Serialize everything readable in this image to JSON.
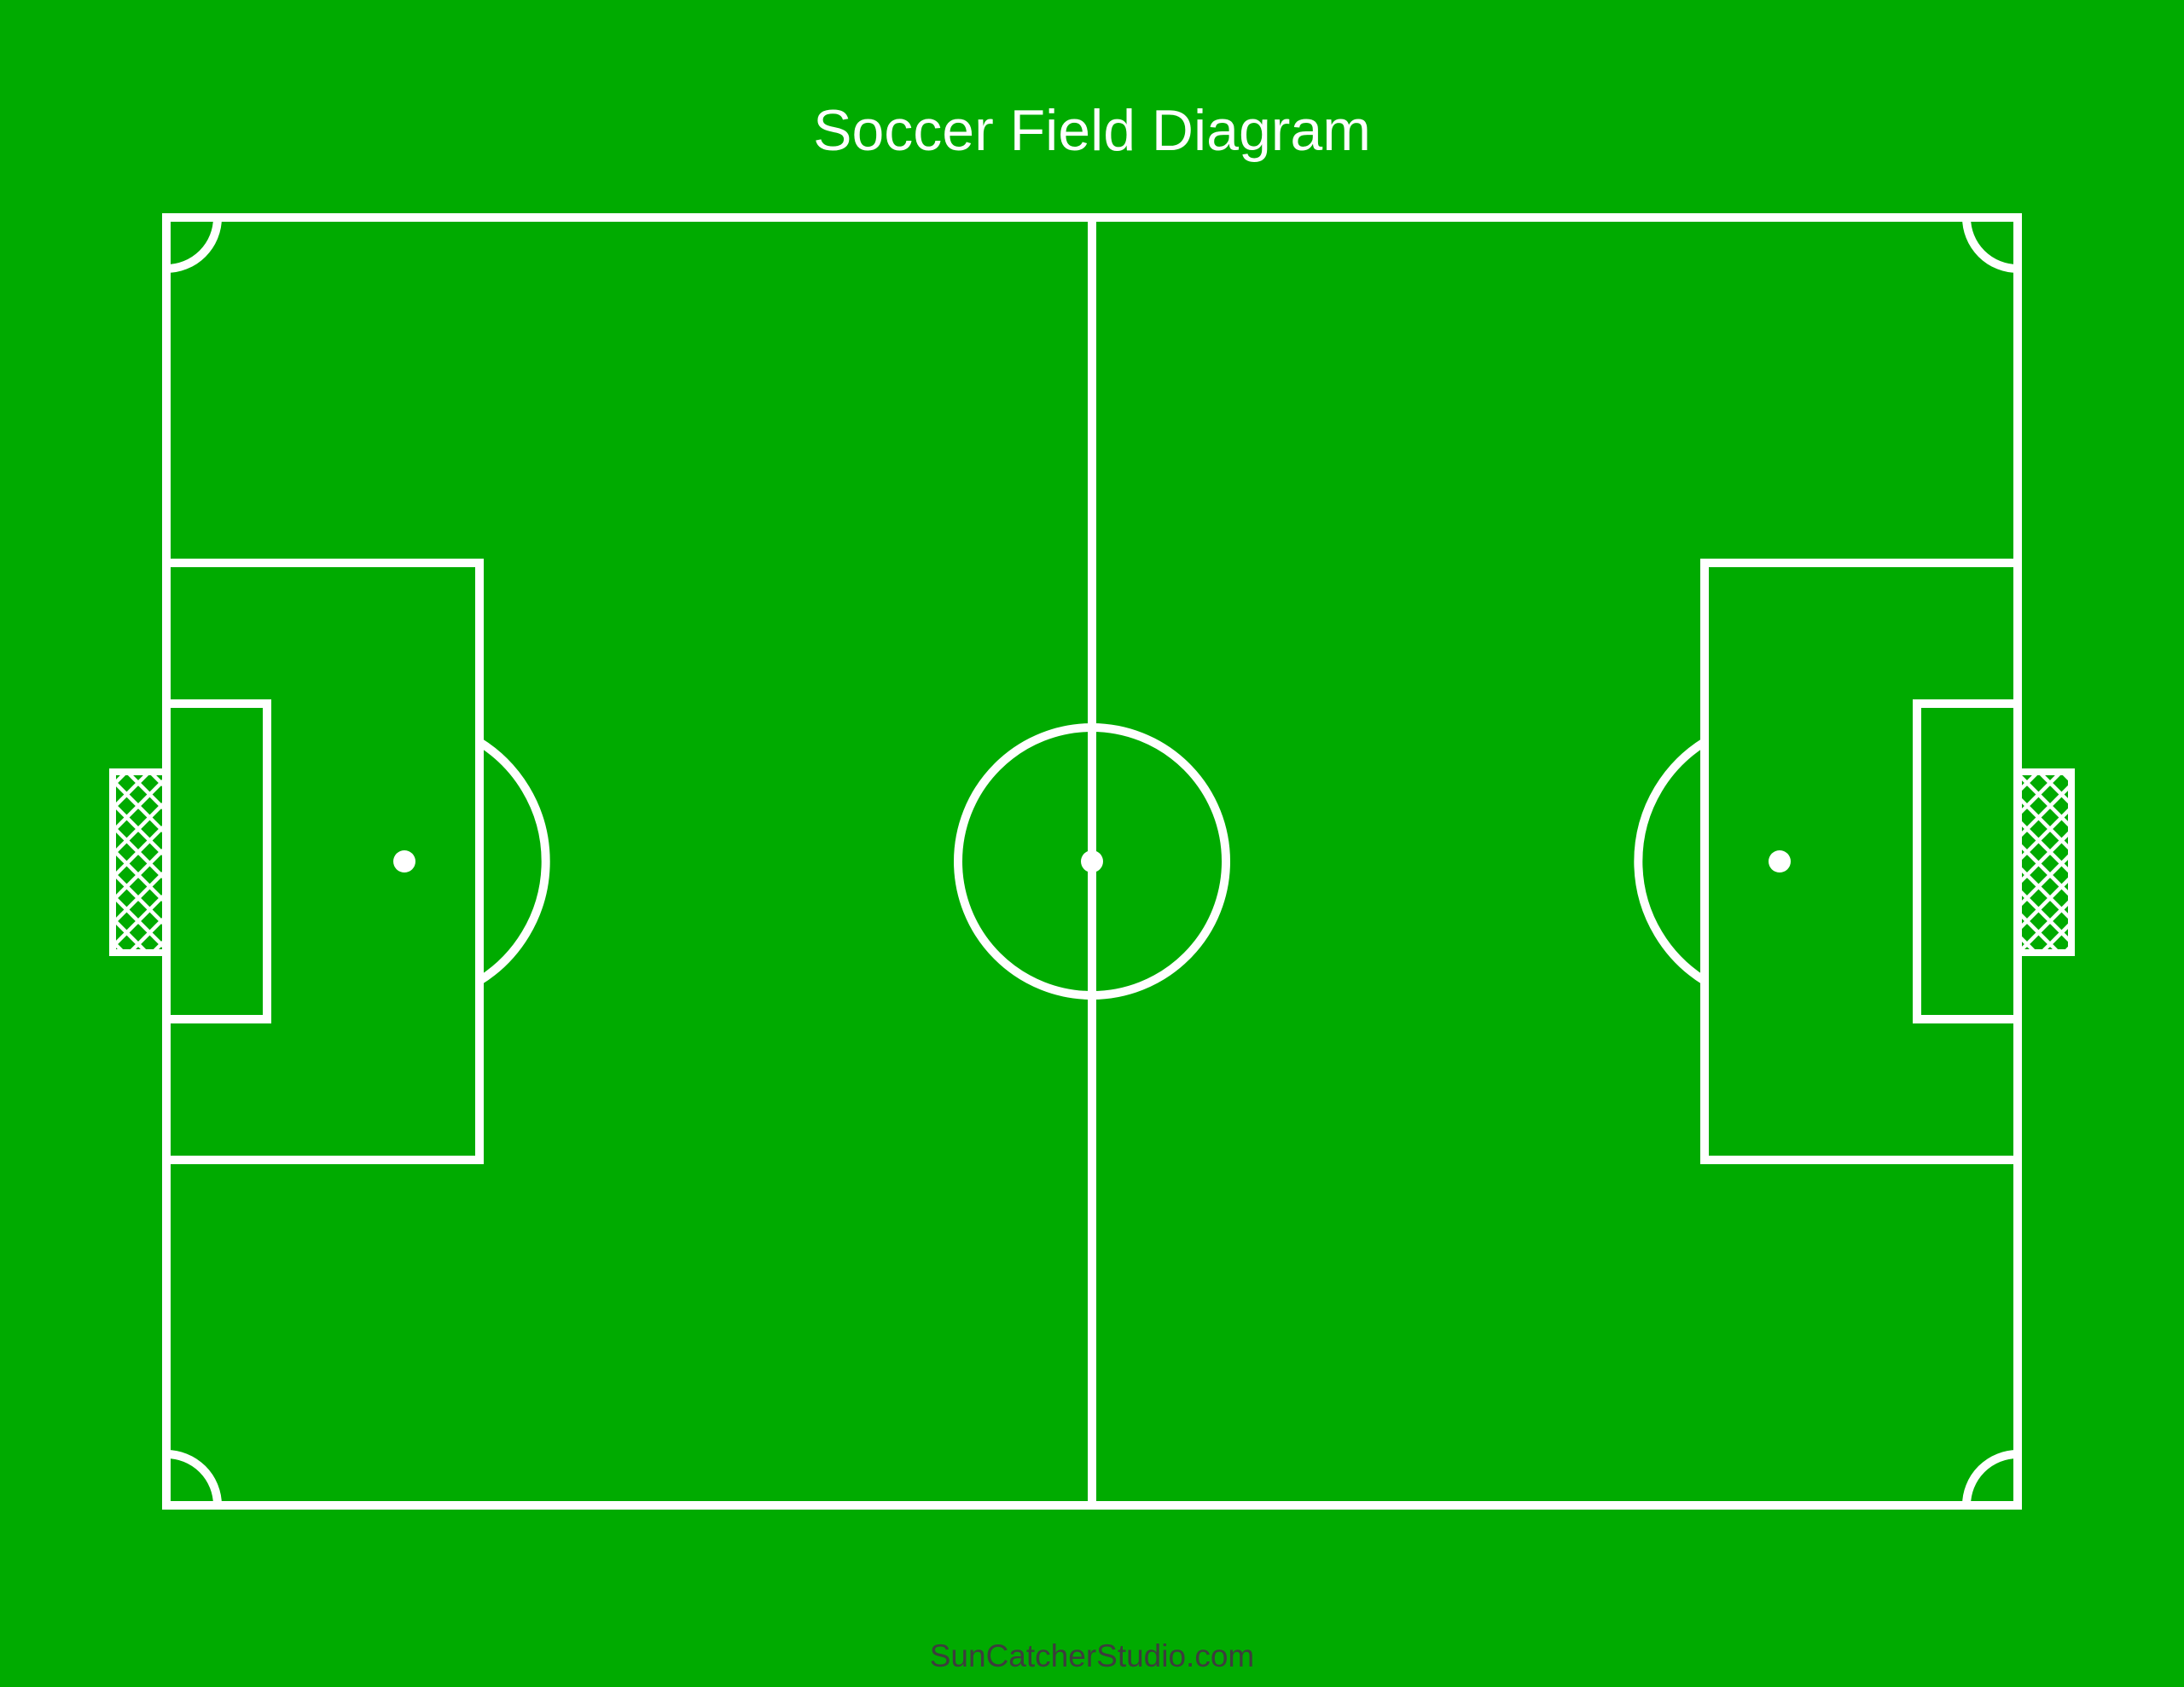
{
  "page": {
    "title": "Soccer Field Diagram",
    "watermark": "SunCatcherStudio.com"
  },
  "colors": {
    "field-green": "#00AB00",
    "line-white": "#FFFFFF",
    "watermark-gray": "#3D3D3D"
  }
}
